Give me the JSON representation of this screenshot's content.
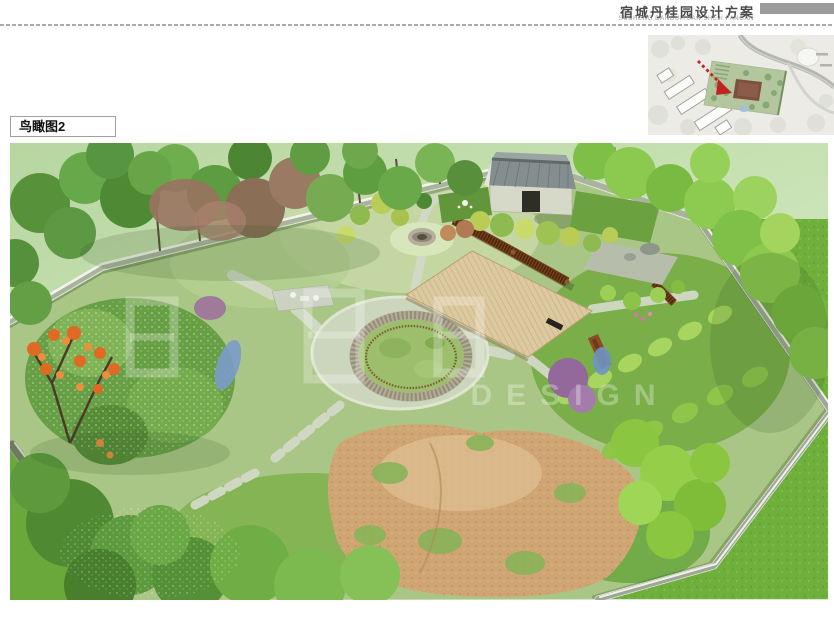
{
  "header": {
    "title": "宿城丹桂园设计方案",
    "subtitle": "SUCHENG DANGUIYUAN SHEJI FANGAN"
  },
  "section_label": "鸟瞰图2",
  "watermark_text": "DESIGN",
  "colors": {
    "header_bar_gray": "#9c9c9c",
    "title_text": "#4a4a4a",
    "arrow_red": "#c32222",
    "wall_stone": "#dfe5d8",
    "deck_wood": "#dcc9a0",
    "trellis_rust": "#7a431c",
    "soil_tan": "#cfa673",
    "lawn_green": "#6fb03c"
  }
}
